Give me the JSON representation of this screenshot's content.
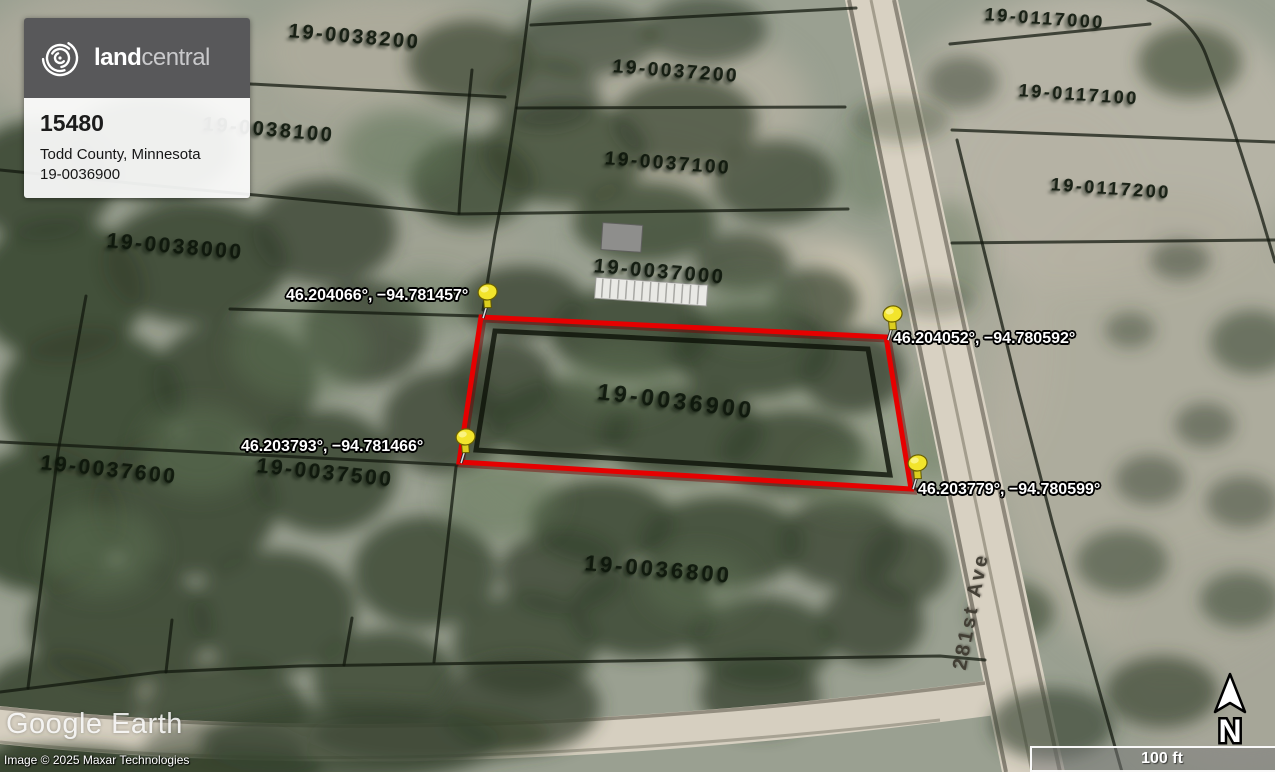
{
  "card": {
    "brand_bold": "land",
    "brand_light": "central",
    "listing_id": "15480",
    "location": "Todd County, Minnesota",
    "parcel_id": "19-0036900"
  },
  "map": {
    "parcel_labels": [
      "19-0038200",
      "19-0037200",
      "19-0117000",
      "19-0038100",
      "19-0037100",
      "19-0117100",
      "19-0117200",
      "19-0038000",
      "19-0037000",
      "19-0036900",
      "19-0037600",
      "19-0037500",
      "19-0036800"
    ],
    "pins": [
      {
        "label": "46.204066°, −94.781457°"
      },
      {
        "label": "46.204052°, −94.780592°"
      },
      {
        "label": "46.203793°, −94.781466°"
      },
      {
        "label": "46.203779°, −94.780599°"
      }
    ],
    "road_label": "281st Ave",
    "property_outline_color": "#e60000",
    "pin_color": "#f2e42c"
  },
  "watermark": {
    "logo": "Google Earth",
    "copyright": "Image © 2025 Maxar Technologies"
  },
  "navigation": {
    "north_label": "N",
    "scale_label": "100 ft"
  }
}
